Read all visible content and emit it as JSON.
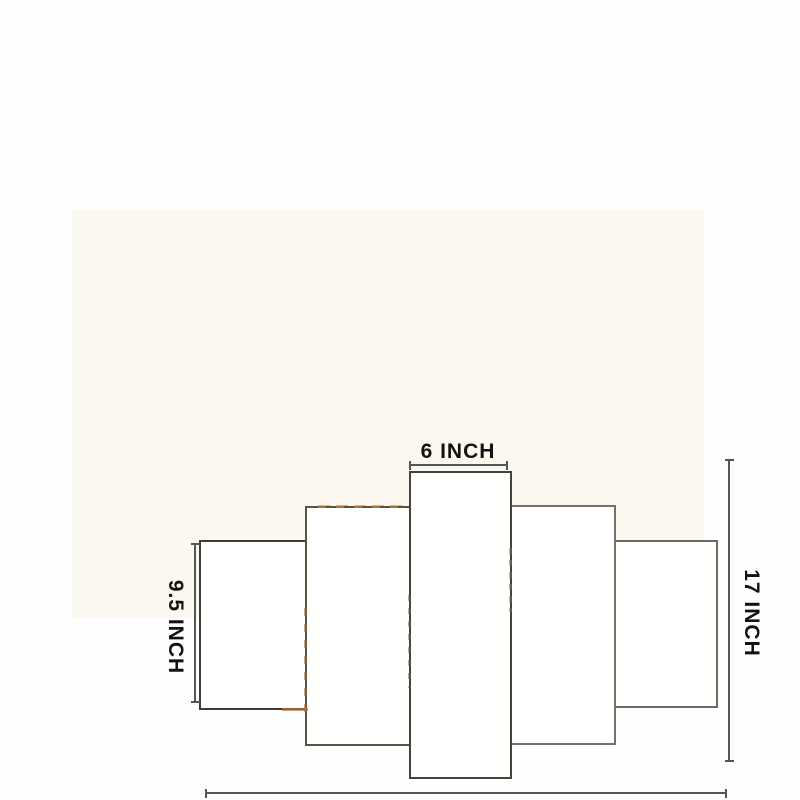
{
  "colors": {
    "page_background": "#fefefe",
    "photo_background": "#faf8ef",
    "panel_fill": "#fffffe",
    "panel_border": "#4a4742",
    "dimension_line": "#565553",
    "label_text": "#121212",
    "print_edge_warm": "#c08a48"
  },
  "diagram": {
    "panel_count": 5,
    "dimension_labels": {
      "top": "6 INCH",
      "left": "9.5 INCH",
      "right": "17 INCH",
      "bottom": "30 INCH"
    }
  }
}
